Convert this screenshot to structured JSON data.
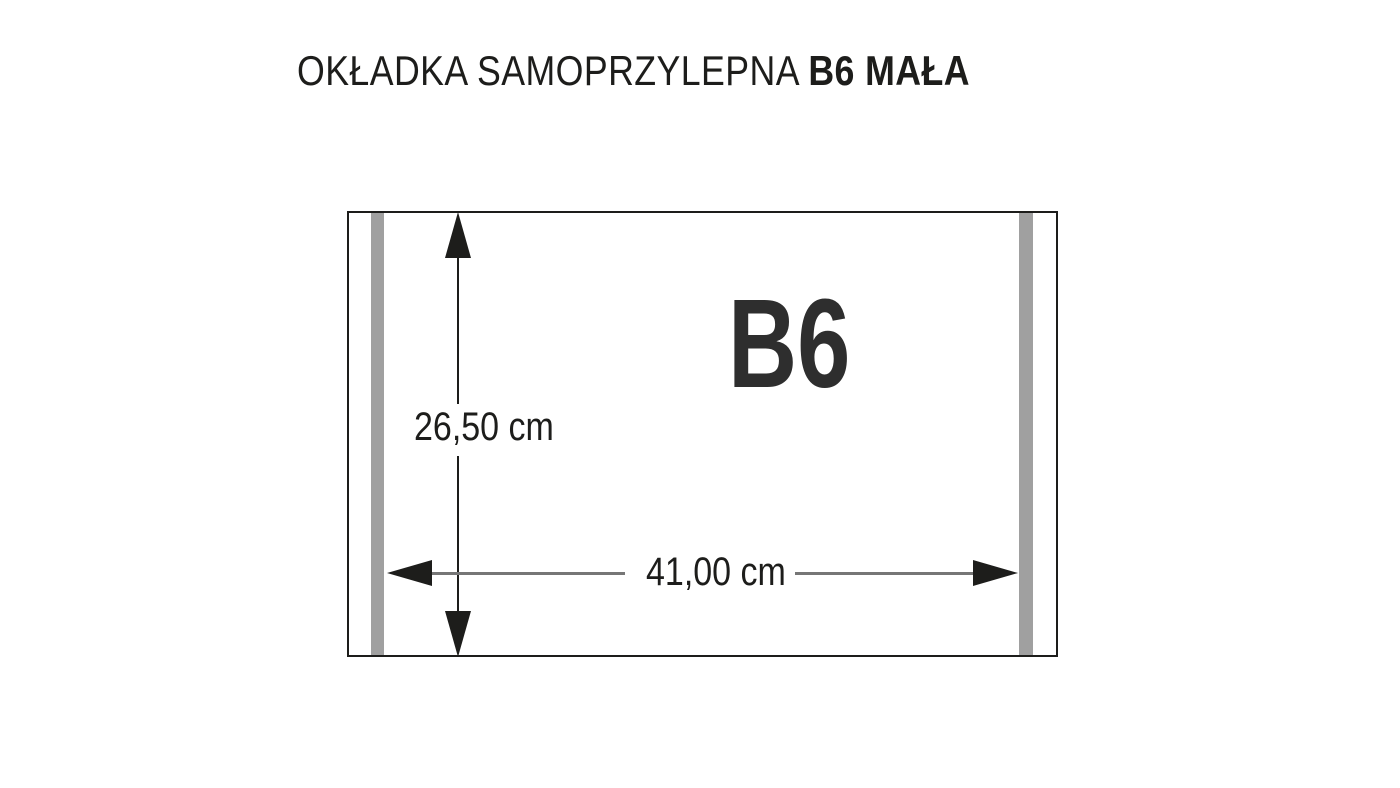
{
  "title": {
    "regular": "OKŁADKA SAMOPRZYLEPNA ",
    "bold": "B6 MAŁA"
  },
  "diagram": {
    "format_label": "B6",
    "height_value": "26,50 cm",
    "width_value": "41,00 cm",
    "colors": {
      "ink": "#1d1d1b",
      "label": "#2e2e2e",
      "strip": "#a0a0a0",
      "dim_line": "#767676"
    }
  }
}
